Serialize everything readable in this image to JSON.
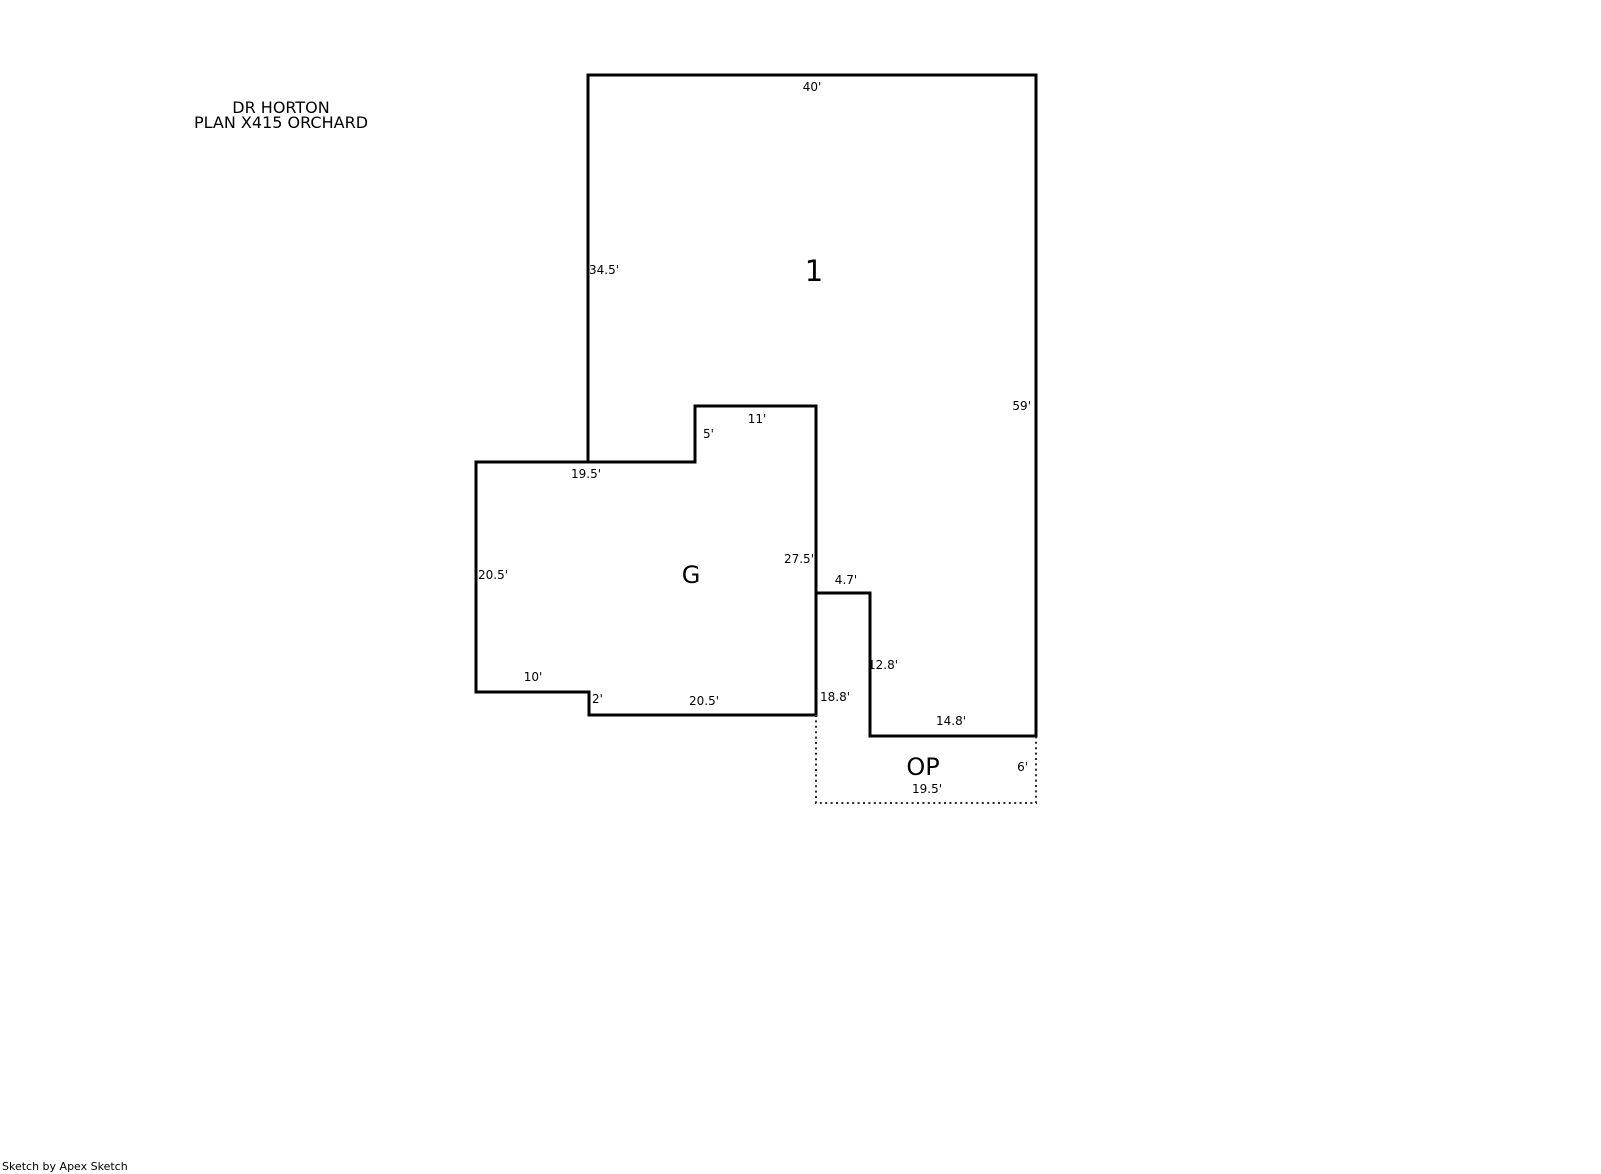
{
  "title": {
    "line1": "DR HORTON",
    "line2": "PLAN X415 ORCHARD"
  },
  "areas": {
    "living": {
      "label": "1"
    },
    "garage": {
      "label": "G"
    },
    "patio": {
      "label": "OP"
    }
  },
  "dimensions": {
    "area1_top": "40'",
    "area1_left": "34.5'",
    "area1_right": "59'",
    "notch_top": "11'",
    "notch_step": "5'",
    "garage_top": "19.5'",
    "garage_left": "20.5'",
    "garage_right": "27.5'",
    "garage_step_width": "10'",
    "garage_step_height": "2'",
    "garage_bottom": "20.5'",
    "patio_top": "4.7'",
    "patio_left": "18.8'",
    "patio_inner_vertical": "12.8'",
    "patio_inner_horizontal": "14.8'",
    "patio_right": "6'",
    "patio_bottom": "19.5'"
  },
  "footer": {
    "credit": "Sketch by Apex Sketch"
  },
  "colors": {
    "wall": "#000000",
    "open_edge": "#2a2a2a",
    "background": "#ffffff"
  }
}
